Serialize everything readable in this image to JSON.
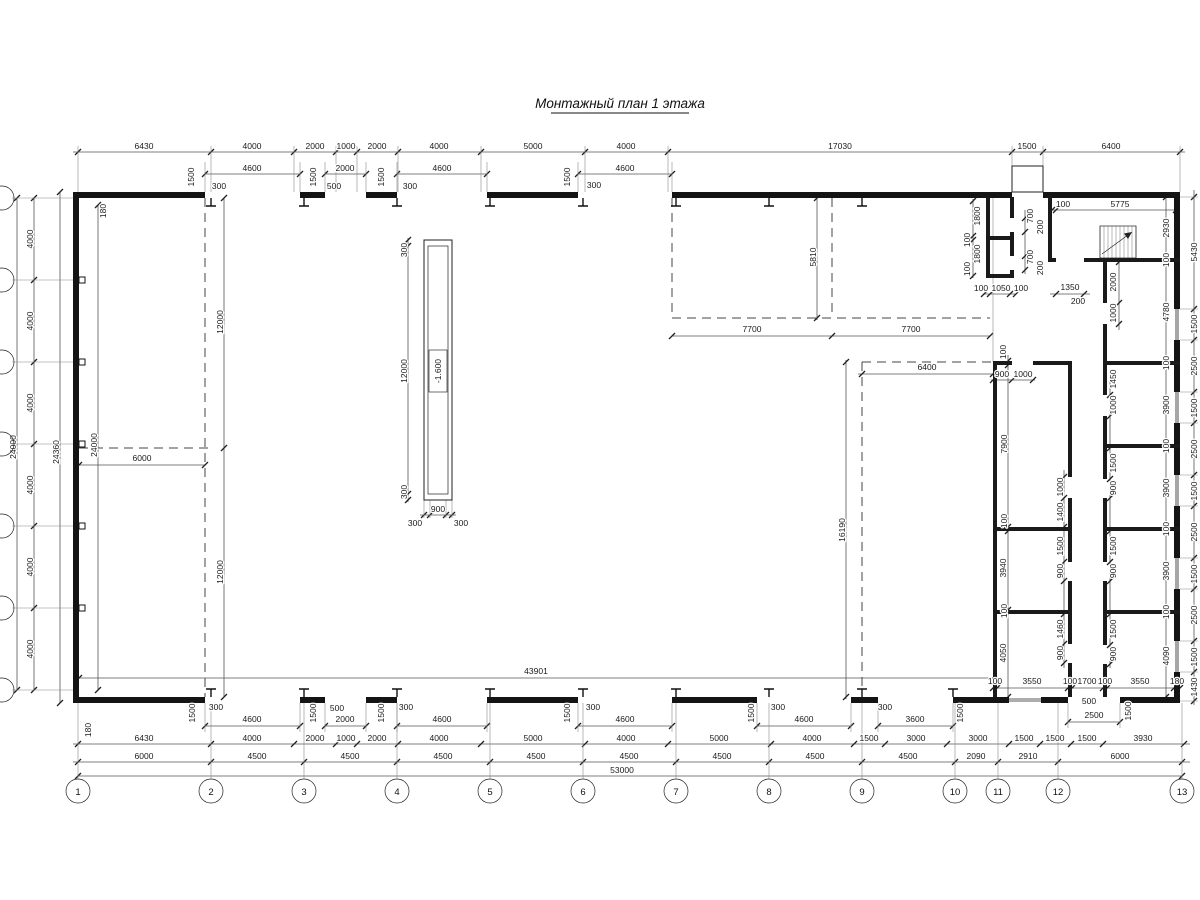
{
  "title": "Монтажный план 1 этажа",
  "axes": {
    "bottom": [
      "1",
      "2",
      "3",
      "4",
      "5",
      "6",
      "7",
      "8",
      "9",
      "10",
      "11",
      "12",
      "13"
    ]
  },
  "dims": {
    "top_chain": [
      "6430",
      "4000",
      "2000",
      "1000",
      "2000",
      "4000",
      "5000",
      "4000",
      "17030",
      "1500",
      "6400"
    ],
    "top_open": [
      "4600",
      "2000",
      "4600",
      "4600"
    ],
    "top_marks": [
      "1500",
      "300",
      "1500",
      "500",
      "1500",
      "300",
      "1500",
      "300"
    ],
    "bot_open": [
      "4600",
      "2000",
      "4600",
      "4600",
      "4600",
      "3600",
      "2500"
    ],
    "bot_marks": [
      "1500",
      "300",
      "1500",
      "500",
      "1500",
      "300",
      "1500",
      "300",
      "1500",
      "300",
      "1500",
      "300",
      "1500",
      "500"
    ],
    "chain1": [
      "6430",
      "4000",
      "2000",
      "1000",
      "2000",
      "4000",
      "5000",
      "4000",
      "5000",
      "4000",
      "1500",
      "3000",
      "3000",
      "1500",
      "1500",
      "1500",
      "3930"
    ],
    "chain2": [
      "6000",
      "4500",
      "4500",
      "4500",
      "4500",
      "4500",
      "4500",
      "4500",
      "4500",
      "2090",
      "2910",
      "6000"
    ],
    "total": "53000",
    "hall_width": "43901",
    "left_seg": [
      "4000",
      "4000",
      "4000",
      "4000",
      "4000",
      "4000"
    ],
    "left_total": "24000",
    "left_outer": "24360",
    "left_inner": "24000",
    "off_180": [
      "180",
      "180"
    ],
    "hall": [
      "12000",
      "12000",
      "6000"
    ],
    "pit": [
      "300",
      "12000",
      "300",
      "300",
      "900",
      "300"
    ],
    "pit_mark": "-1.600",
    "mid": [
      "5810",
      "7700",
      "7700"
    ],
    "right_hall": [
      "6400",
      "16190"
    ],
    "entry": [
      "100",
      "5775",
      "1350",
      "200",
      "2000",
      "1000"
    ],
    "block": [
      "1800",
      "100",
      "1800",
      "100",
      "700",
      "200",
      "700",
      "200",
      "100",
      "1050",
      "100"
    ],
    "wingL_side": [
      "100",
      "7900",
      "100",
      "3940",
      "100",
      "4050"
    ],
    "wingL_top": [
      "900",
      "1000"
    ],
    "wingL_doors": [
      "1000",
      "1400",
      "1500",
      "900",
      "1460",
      "900"
    ],
    "wingR_doors": [
      "1450",
      "1000",
      "1500",
      "900",
      "1500",
      "900",
      "1500",
      "900"
    ],
    "right_inner": [
      "2930",
      "100",
      "4780",
      "100",
      "3900",
      "100",
      "3900",
      "100",
      "3900",
      "100",
      "4090"
    ],
    "right_outer": [
      "5430",
      "1500",
      "2500",
      "1500",
      "2500",
      "1500",
      "2500",
      "1500",
      "2500",
      "1500",
      "1430"
    ],
    "wing_bottom": [
      "100",
      "3550",
      "100",
      "1700",
      "100",
      "3550",
      "180"
    ]
  }
}
